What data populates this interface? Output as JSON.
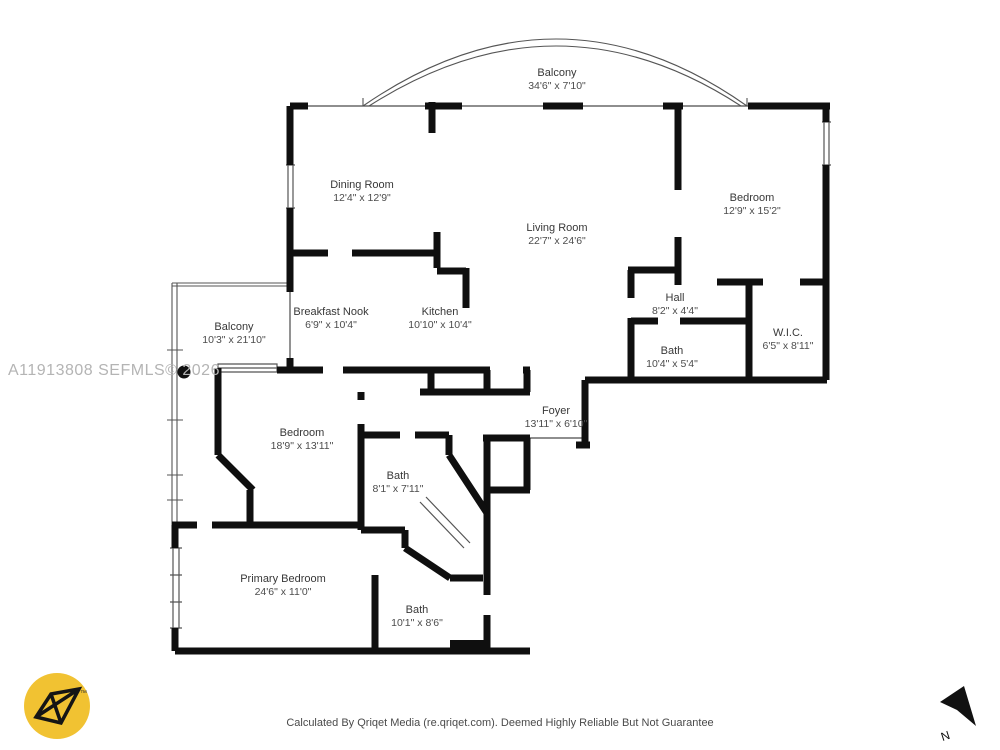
{
  "watermark": {
    "text": "A11913808  SEFMLS© 2026"
  },
  "footer": {
    "text": "Calculated By Qriqet Media (re.qriqet.com). Deemed Highly Reliable But Not Guarantee"
  },
  "compass": {
    "label": "N"
  },
  "logo": {
    "tm": "™"
  },
  "colors": {
    "wall": "#0f0f0f",
    "thin_line": "#4a4a4a",
    "window_line": "#555555",
    "logo_yellow": "#f1c232",
    "watermark_gray": "#b4b4b4"
  },
  "rooms": [
    {
      "id": "balcony-top",
      "name": "Balcony",
      "dims": "34'6\" x 7'10\"",
      "x": 557,
      "y": 80
    },
    {
      "id": "dining-room",
      "name": "Dining Room",
      "dims": "12'4\" x 12'9\"",
      "x": 362,
      "y": 192
    },
    {
      "id": "living-room",
      "name": "Living Room",
      "dims": "22'7\" x 24'6\"",
      "x": 557,
      "y": 235
    },
    {
      "id": "bedroom-right",
      "name": "Bedroom",
      "dims": "12'9\" x 15'2\"",
      "x": 752,
      "y": 205
    },
    {
      "id": "breakfast-nook",
      "name": "Breakfast Nook",
      "dims": "6'9\" x 10'4\"",
      "x": 331,
      "y": 319
    },
    {
      "id": "kitchen",
      "name": "Kitchen",
      "dims": "10'10\" x 10'4\"",
      "x": 440,
      "y": 319
    },
    {
      "id": "hall",
      "name": "Hall",
      "dims": "8'2\" x 4'4\"",
      "x": 675,
      "y": 305
    },
    {
      "id": "wic",
      "name": "W.I.C.",
      "dims": "6'5\" x 8'11\"",
      "x": 788,
      "y": 340
    },
    {
      "id": "bath-hall",
      "name": "Bath",
      "dims": "10'4\" x 5'4\"",
      "x": 672,
      "y": 358
    },
    {
      "id": "balcony-left",
      "name": "Balcony",
      "dims": "10'3\" x 21'10\"",
      "x": 234,
      "y": 334
    },
    {
      "id": "foyer",
      "name": "Foyer",
      "dims": "13'11\" x 6'10\"",
      "x": 556,
      "y": 418
    },
    {
      "id": "bedroom-mid",
      "name": "Bedroom",
      "dims": "18'9\" x 13'11\"",
      "x": 302,
      "y": 440
    },
    {
      "id": "bath-mid",
      "name": "Bath",
      "dims": "8'1\" x 7'11\"",
      "x": 398,
      "y": 483
    },
    {
      "id": "primary-bedroom",
      "name": "Primary Bedroom",
      "dims": "24'6\" x 11'0\"",
      "x": 283,
      "y": 586
    },
    {
      "id": "bath-lower",
      "name": "Bath",
      "dims": "10'1\" x 8'6\"",
      "x": 417,
      "y": 617
    }
  ]
}
